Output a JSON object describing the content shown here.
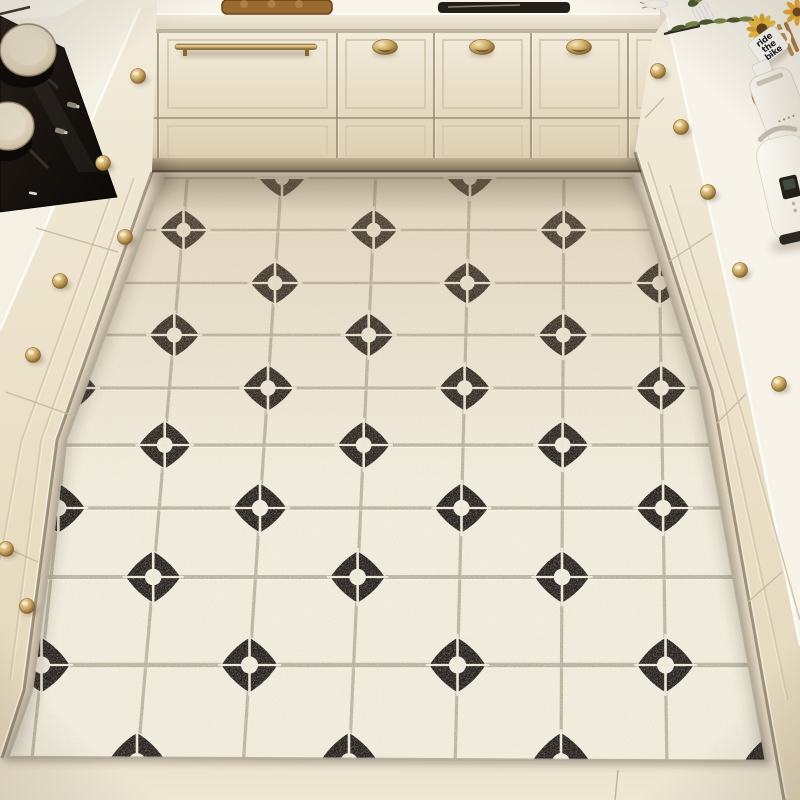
{
  "meta": {
    "subject": "kitchen floor mat product photo",
    "view": "top-down U-shaped cream kitchen with black-and-white diamond tile mat"
  },
  "right_counter": {
    "mug": {
      "line1": "ride",
      "line2": "the",
      "line3": "bike"
    }
  },
  "scene": {
    "palette": {
      "floor": "#e8ddc7",
      "floor_light": "#f1e9d8",
      "mat_tile": "#efe9d9",
      "grout": "#b5ae9a",
      "cross": "#ece6d6",
      "diamond": "#221d18",
      "counter": "#f8f4ea",
      "counter_edge": "#fdfbf6",
      "cab_light": "#f2ebdb",
      "cab_dark": "#ddd0b3",
      "side_light": "#f3ecdc",
      "side_dark": "#e2d5ba",
      "seam": "#9a8d72",
      "molding": "#d5c8ac",
      "kick_hi": "#c3b394",
      "kick_lo": "#7d7057",
      "gold": "#c9a660",
      "gold_dark": "#7d5c28",
      "gold_light": "#f6e7bb",
      "cooktop": "#18130f",
      "pot": "#e9e0cb",
      "wood": "#cc9d60",
      "wood_dark": "#a87c42",
      "leaf_dark": "#4a5830",
      "leaf_light": "#78874b",
      "stem": "#3e4a2c",
      "sunflower": "#eabc41",
      "sunflower_core": "#5f421f",
      "appliance": "#fbf9f4",
      "appliance_edge": "#d9d1c0",
      "display": "#23201b",
      "board_brown": "#9a6a33",
      "tray_dark": "#241f19",
      "text_dark": "#1c1c1c"
    },
    "mat": {
      "clip": [
        [
          164,
          176
        ],
        [
          633,
          176
        ],
        [
          700,
          390
        ],
        [
          766,
          761
        ],
        [
          8,
          757
        ],
        [
          32,
          690
        ],
        [
          66,
          440
        ]
      ],
      "rows": [
        178,
        230,
        283,
        335,
        388,
        445,
        508,
        577,
        665,
        762
      ],
      "row_widths": [
        2.2,
        2.4,
        2.6,
        2.8,
        3.0,
        3.3,
        3.6,
        4.0,
        4.5,
        5.0
      ],
      "col_top_center": 470,
      "col_top_spacing": 94,
      "col_bottom_center": 455,
      "col_bottom_spacing": 106,
      "col_range": 4,
      "y_top": 178,
      "y_bottom": 762,
      "diamond_ratio_top": 0.25,
      "diamond_ratio_bottom": 0.28,
      "squash_top": 0.84,
      "hole_ratio": 0.3
    },
    "back_unit": {
      "x": 108,
      "w": 552,
      "surface_h": 14,
      "slab_h": 15,
      "row1": [
        33,
        117
      ],
      "row2": [
        119,
        158
      ],
      "kick": [
        158,
        172
      ],
      "seams": [
        158,
        337,
        434,
        531,
        628
      ],
      "moldings_row1": [
        [
          116,
          150
        ],
        [
          168,
          327
        ],
        [
          346,
          425
        ],
        [
          443,
          522
        ],
        [
          540,
          619
        ],
        [
          637,
          658
        ]
      ],
      "bar_handle": {
        "x": 175,
        "w": 142,
        "y": 44
      },
      "cup_handles": [
        [
          385,
          47
        ],
        [
          482,
          47
        ],
        [
          579,
          47
        ],
        [
          137,
          77
        ]
      ],
      "board": {
        "x": 222,
        "w": 110,
        "h": 14
      },
      "tray": {
        "x": 438,
        "w": 132,
        "h": 11
      }
    },
    "left_unit": {
      "outline": [
        [
          0,
          0
        ],
        [
          157,
          0
        ],
        [
          152,
          172
        ],
        [
          57,
          440
        ],
        [
          24,
          690
        ],
        [
          2,
          758
        ],
        [
          0,
          758
        ]
      ],
      "surface": [
        [
          0,
          0
        ],
        [
          157,
          0
        ],
        [
          140,
          8
        ],
        [
          58,
          197
        ],
        [
          0,
          330
        ]
      ],
      "counter_edge": [
        [
          140,
          8
        ],
        [
          58,
          197
        ],
        [
          0,
          330
        ]
      ],
      "cooktop": [
        [
          0,
          16
        ],
        [
          64,
          48
        ],
        [
          117,
          197
        ],
        [
          0,
          212
        ]
      ],
      "pots": [
        {
          "cx": 28,
          "cy": 50,
          "r": 28
        },
        {
          "cx": 8,
          "cy": 126,
          "r": 26
        }
      ],
      "knobs": [
        [
          138,
          76
        ],
        [
          103,
          163
        ],
        [
          125,
          237
        ],
        [
          60,
          281
        ],
        [
          33,
          355
        ],
        [
          6,
          549
        ],
        [
          27,
          606
        ]
      ],
      "molding_a": [
        [
          134,
          178
        ],
        [
          41,
          440
        ],
        [
          10,
          680
        ]
      ],
      "molding_b": [
        [
          114,
          186
        ],
        [
          21,
          442
        ],
        [
          0,
          560
        ]
      ],
      "seams": [
        [
          [
            118,
            252
          ],
          [
            36,
            228
          ]
        ],
        [
          [
            74,
            416
          ],
          [
            6,
            392
          ]
        ],
        [
          [
            38,
            562
          ],
          [
            0,
            545
          ]
        ]
      ],
      "wedge": [
        [
          0,
          0
        ],
        [
          86,
          0
        ],
        [
          58,
          16
        ],
        [
          0,
          20
        ]
      ]
    },
    "right_unit": {
      "outline": [
        [
          652,
          38
        ],
        [
          667,
          17
        ],
        [
          655,
          0
        ],
        [
          800,
          0
        ],
        [
          800,
          800
        ],
        [
          784,
          800
        ],
        [
          712,
          390
        ],
        [
          635,
          152
        ]
      ],
      "surface": [
        [
          655,
          0
        ],
        [
          800,
          0
        ],
        [
          800,
          648
        ],
        [
          730,
          300
        ],
        [
          667,
          17
        ]
      ],
      "counter_edge": [
        [
          667,
          17
        ],
        [
          730,
          300
        ],
        [
          800,
          645
        ]
      ],
      "boundary": [
        [
          635,
          152
        ],
        [
          712,
          390
        ],
        [
          784,
          800
        ]
      ],
      "knobs": [
        [
          658,
          71
        ],
        [
          681,
          127
        ],
        [
          708,
          192
        ],
        [
          740,
          270
        ],
        [
          779,
          384
        ]
      ],
      "molding_a": [
        [
          648,
          162
        ],
        [
          724,
          400
        ],
        [
          788,
          700
        ]
      ],
      "molding_b": [
        [
          670,
          185
        ],
        [
          744,
          420
        ],
        [
          800,
          620
        ]
      ],
      "seams": [
        [
          [
            668,
            262
          ],
          [
            712,
            233
          ]
        ],
        [
          [
            716,
            424
          ],
          [
            746,
            394
          ]
        ],
        [
          [
            748,
            602
          ],
          [
            782,
            572
          ]
        ],
        [
          [
            645,
            118
          ],
          [
            664,
            98
          ]
        ]
      ]
    },
    "floor": {
      "seam": [
        [
          618,
          770
        ],
        [
          615,
          800
        ]
      ]
    }
  }
}
